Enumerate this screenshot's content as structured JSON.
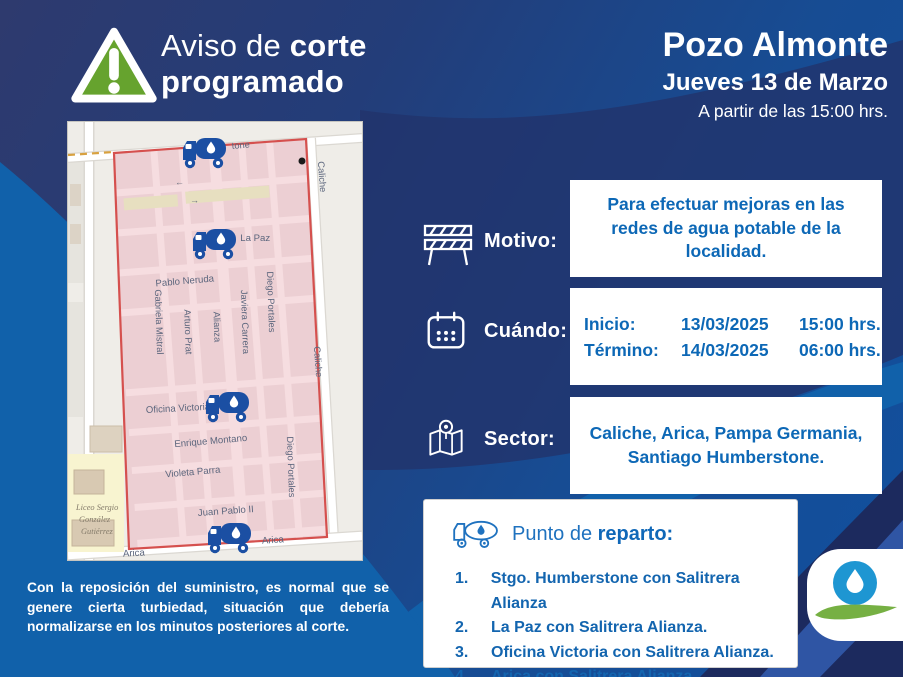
{
  "header": {
    "warning_icon": "warning-triangle-icon",
    "alert_regular": "Aviso de ",
    "alert_bold": "corte",
    "alert_line2": "programado",
    "location": "Pozo Almonte",
    "date": "Jueves 13 de Marzo",
    "start_note": "A partir de las 15:00 hrs."
  },
  "info_rows": [
    {
      "icon": "barrier-icon",
      "label": "Motivo:",
      "text": "Para efectuar mejoras en las redes de agua potable de la localidad."
    },
    {
      "icon": "calendar-icon",
      "label": "Cuándo:",
      "schedule": [
        {
          "name": "Inicio:",
          "date": "13/03/2025",
          "time": "15:00 hrs."
        },
        {
          "name": "Término:",
          "date": "14/03/2025",
          "time": "06:00 hrs."
        }
      ]
    },
    {
      "icon": "sector-map-icon",
      "label": "Sector:",
      "text": "Caliche, Arica, Pampa Germania, Santiago Humberstone."
    }
  ],
  "reparto": {
    "icon": "water-truck-outline-icon",
    "title_regular": "Punto de ",
    "title_bold": "reparto:",
    "items": [
      {
        "num": "1.",
        "text": "Stgo. Humberstone con Salitrera Alianza"
      },
      {
        "num": "2.",
        "text": "La Paz con Salitrera Alianza."
      },
      {
        "num": "3.",
        "text": "Oficina Victoria con Salitrera Alianza."
      },
      {
        "num": "4.",
        "text": "Arica con Salitrera Alianza."
      }
    ]
  },
  "disclaimer": "Con la reposición del suministro, es normal que se genere cierta turbiedad, situación que debería normalizarse en los minutos posteriores al corte.",
  "map": {
    "truck_marker_icon": "water-truck-marker",
    "labels": [
      "tone",
      "Caliche",
      "← La Paz",
      "Pablo Neruda",
      "Gabriela Mistral",
      "Arturo Prat",
      "Alianza",
      "Javiera Carrera",
      "Diego Portales",
      "Caliche",
      "Oficina Victoria",
      "Enrique Montano",
      "Violeta Parra",
      "Juan Pablo II",
      "Diego Portales",
      "Arica",
      "Arica",
      "Liceo Sergio",
      "González",
      "Gutiérrez"
    ],
    "arrows": [
      "←",
      "→"
    ]
  },
  "colors": {
    "navy": "#223468",
    "bright_blue": "#1161aa",
    "box_text_blue": "#0d68b6",
    "alert_green": "#66a32e",
    "zone_fill": "#eccfd3",
    "zone_border": "#d5504e",
    "logo_blue": "#1e96d2",
    "logo_green": "#76b043"
  }
}
